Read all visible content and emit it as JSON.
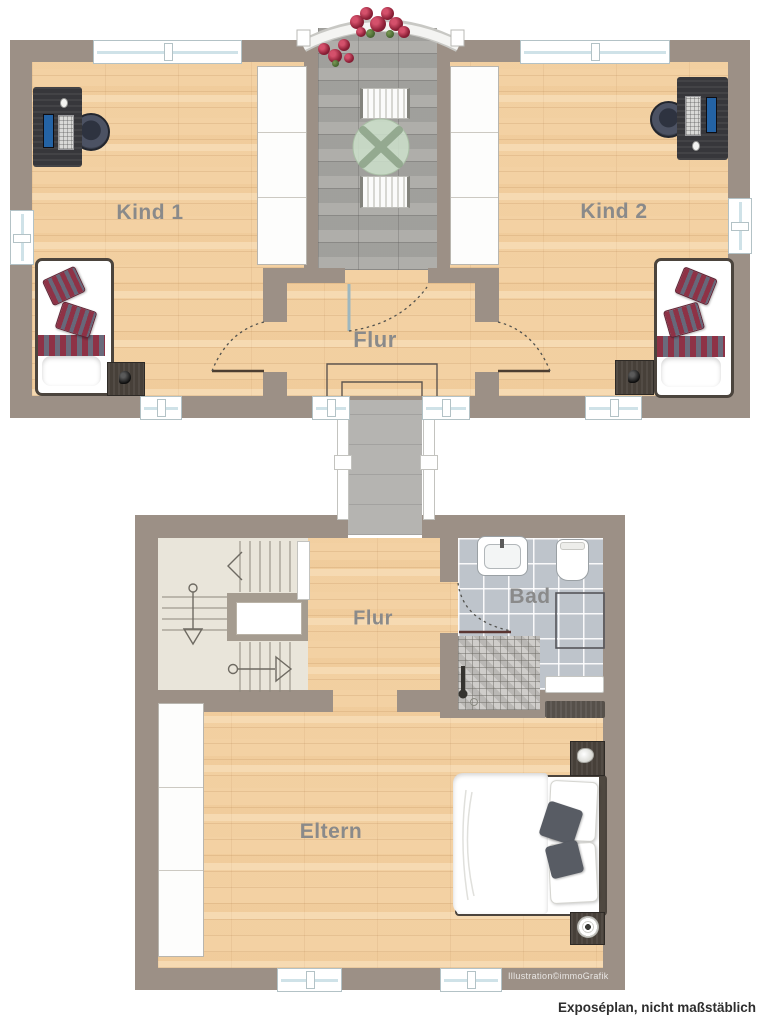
{
  "meta": {
    "credit": "Illustration©immoGrafik",
    "footnote": "Exposéplan, nicht maßstäblich"
  },
  "rooms": {
    "upper": [
      {
        "id": "kind1",
        "label": "Kind 1"
      },
      {
        "id": "flur_og",
        "label": "Flur"
      },
      {
        "id": "kind2",
        "label": "Kind 2"
      }
    ],
    "lower": [
      {
        "id": "flur_eg",
        "label": "Flur"
      },
      {
        "id": "bad",
        "label": "Bad"
      },
      {
        "id": "eltern",
        "label": "Eltern"
      }
    ]
  },
  "colors": {
    "wall": "#9c9086",
    "wood_floor": "#f3d1a3",
    "balcony_pavers": "#a9a8a4",
    "bath_tiles": "#bec4cb",
    "stair_floor": "#e9e5da",
    "pillow_stripe": "#8e3246",
    "label_text": "#8a8a8a"
  }
}
